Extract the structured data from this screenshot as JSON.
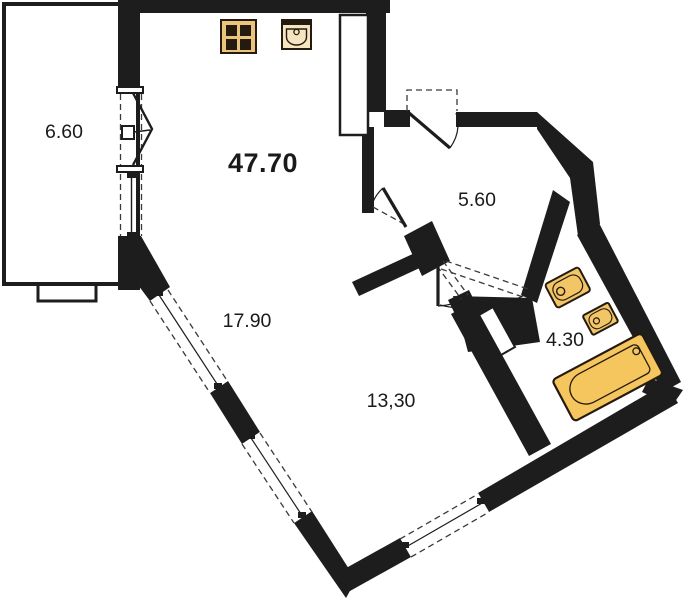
{
  "plan": {
    "type": "apartment-floor-plan",
    "rooms": {
      "balcony": {
        "name": "balcony",
        "label": "6.60"
      },
      "kitchen_living": {
        "name": "kitchen-living-room",
        "label": "47.70"
      },
      "hallway": {
        "name": "hallway",
        "label": "5.60"
      },
      "living_area": {
        "name": "living-area",
        "label": "17.90"
      },
      "bedroom": {
        "name": "bedroom",
        "label": "13,30"
      },
      "bathroom": {
        "name": "bathroom",
        "label": "4.30"
      }
    },
    "fixtures": {
      "stove": "stove-4-burner",
      "kitchen_sink": "kitchen-sink",
      "washbasin": "washbasin",
      "small_basin": "small-basin",
      "bathtub": "bathtub"
    },
    "doors": {
      "entrance": "entrance-door-swing",
      "balcony": "folding-accordion-door",
      "living_hall": "living-to-hall-door",
      "bedroom": "bedroom-door",
      "bathroom": "bathroom-door"
    },
    "windows": [
      "window-southwest-1",
      "window-southwest-2",
      "window-southeast"
    ],
    "colors": {
      "walls": "#1d1d1d",
      "background": "#ffffff",
      "fixture_yellow": "#f5c75f",
      "fixture_cream": "#f4e4c0",
      "stove_tan": "#eac47d",
      "burner_dark": "#241a10"
    }
  }
}
